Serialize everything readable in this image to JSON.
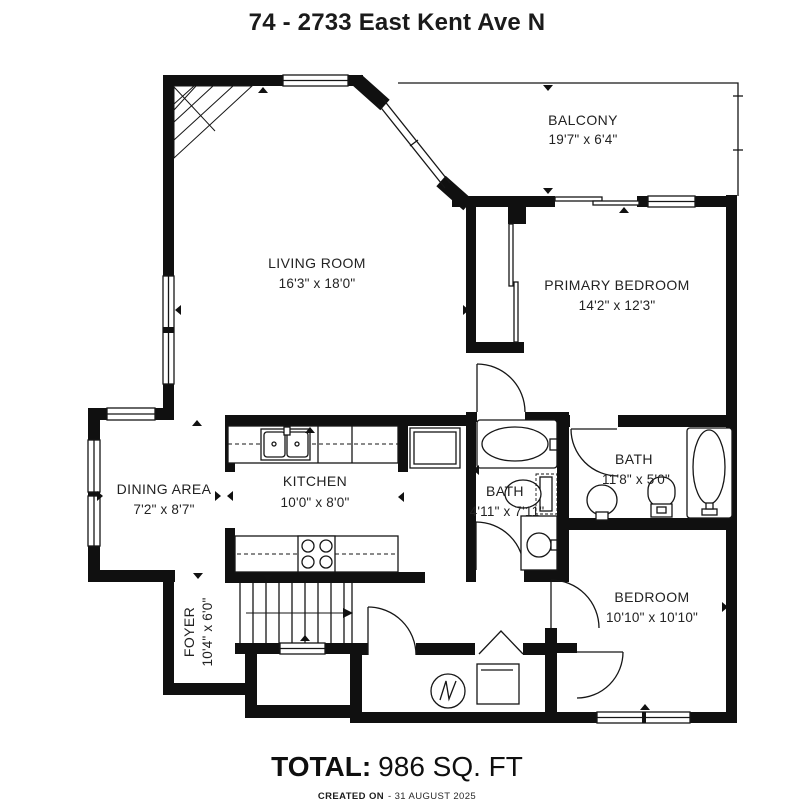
{
  "title": "74 - 2733 East Kent Ave N",
  "rooms": {
    "balcony": {
      "name": "BALCONY",
      "dims": "19'7\" x 6'4\""
    },
    "living_room": {
      "name": "LIVING ROOM",
      "dims": "16'3\" x 18'0\""
    },
    "primary_bedroom": {
      "name": "PRIMARY BEDROOM",
      "dims": "14'2\" x 12'3\""
    },
    "dining_area": {
      "name": "DINING AREA",
      "dims": "7'2\" x 8'7\""
    },
    "kitchen": {
      "name": "KITCHEN",
      "dims": "10'0\" x 8'0\""
    },
    "bath_main": {
      "name": "BATH",
      "dims": "4'11\" x 7'11\""
    },
    "bath_ensuite": {
      "name": "BATH",
      "dims": "11'8\" x 5'0\""
    },
    "bedroom": {
      "name": "BEDROOM",
      "dims": "10'10\" x 10'10\""
    },
    "foyer": {
      "name": "FOYER",
      "dims": "10'4\" x 6'0\""
    }
  },
  "total": {
    "label": "TOTAL:",
    "value": "986 SQ. FT"
  },
  "footer": {
    "created_label": "CREATED ON",
    "created_date": "- 31 AUGUST 2025"
  },
  "colors": {
    "wall": "#101010",
    "line": "#161616",
    "text": "#222222",
    "background": "#ffffff"
  }
}
